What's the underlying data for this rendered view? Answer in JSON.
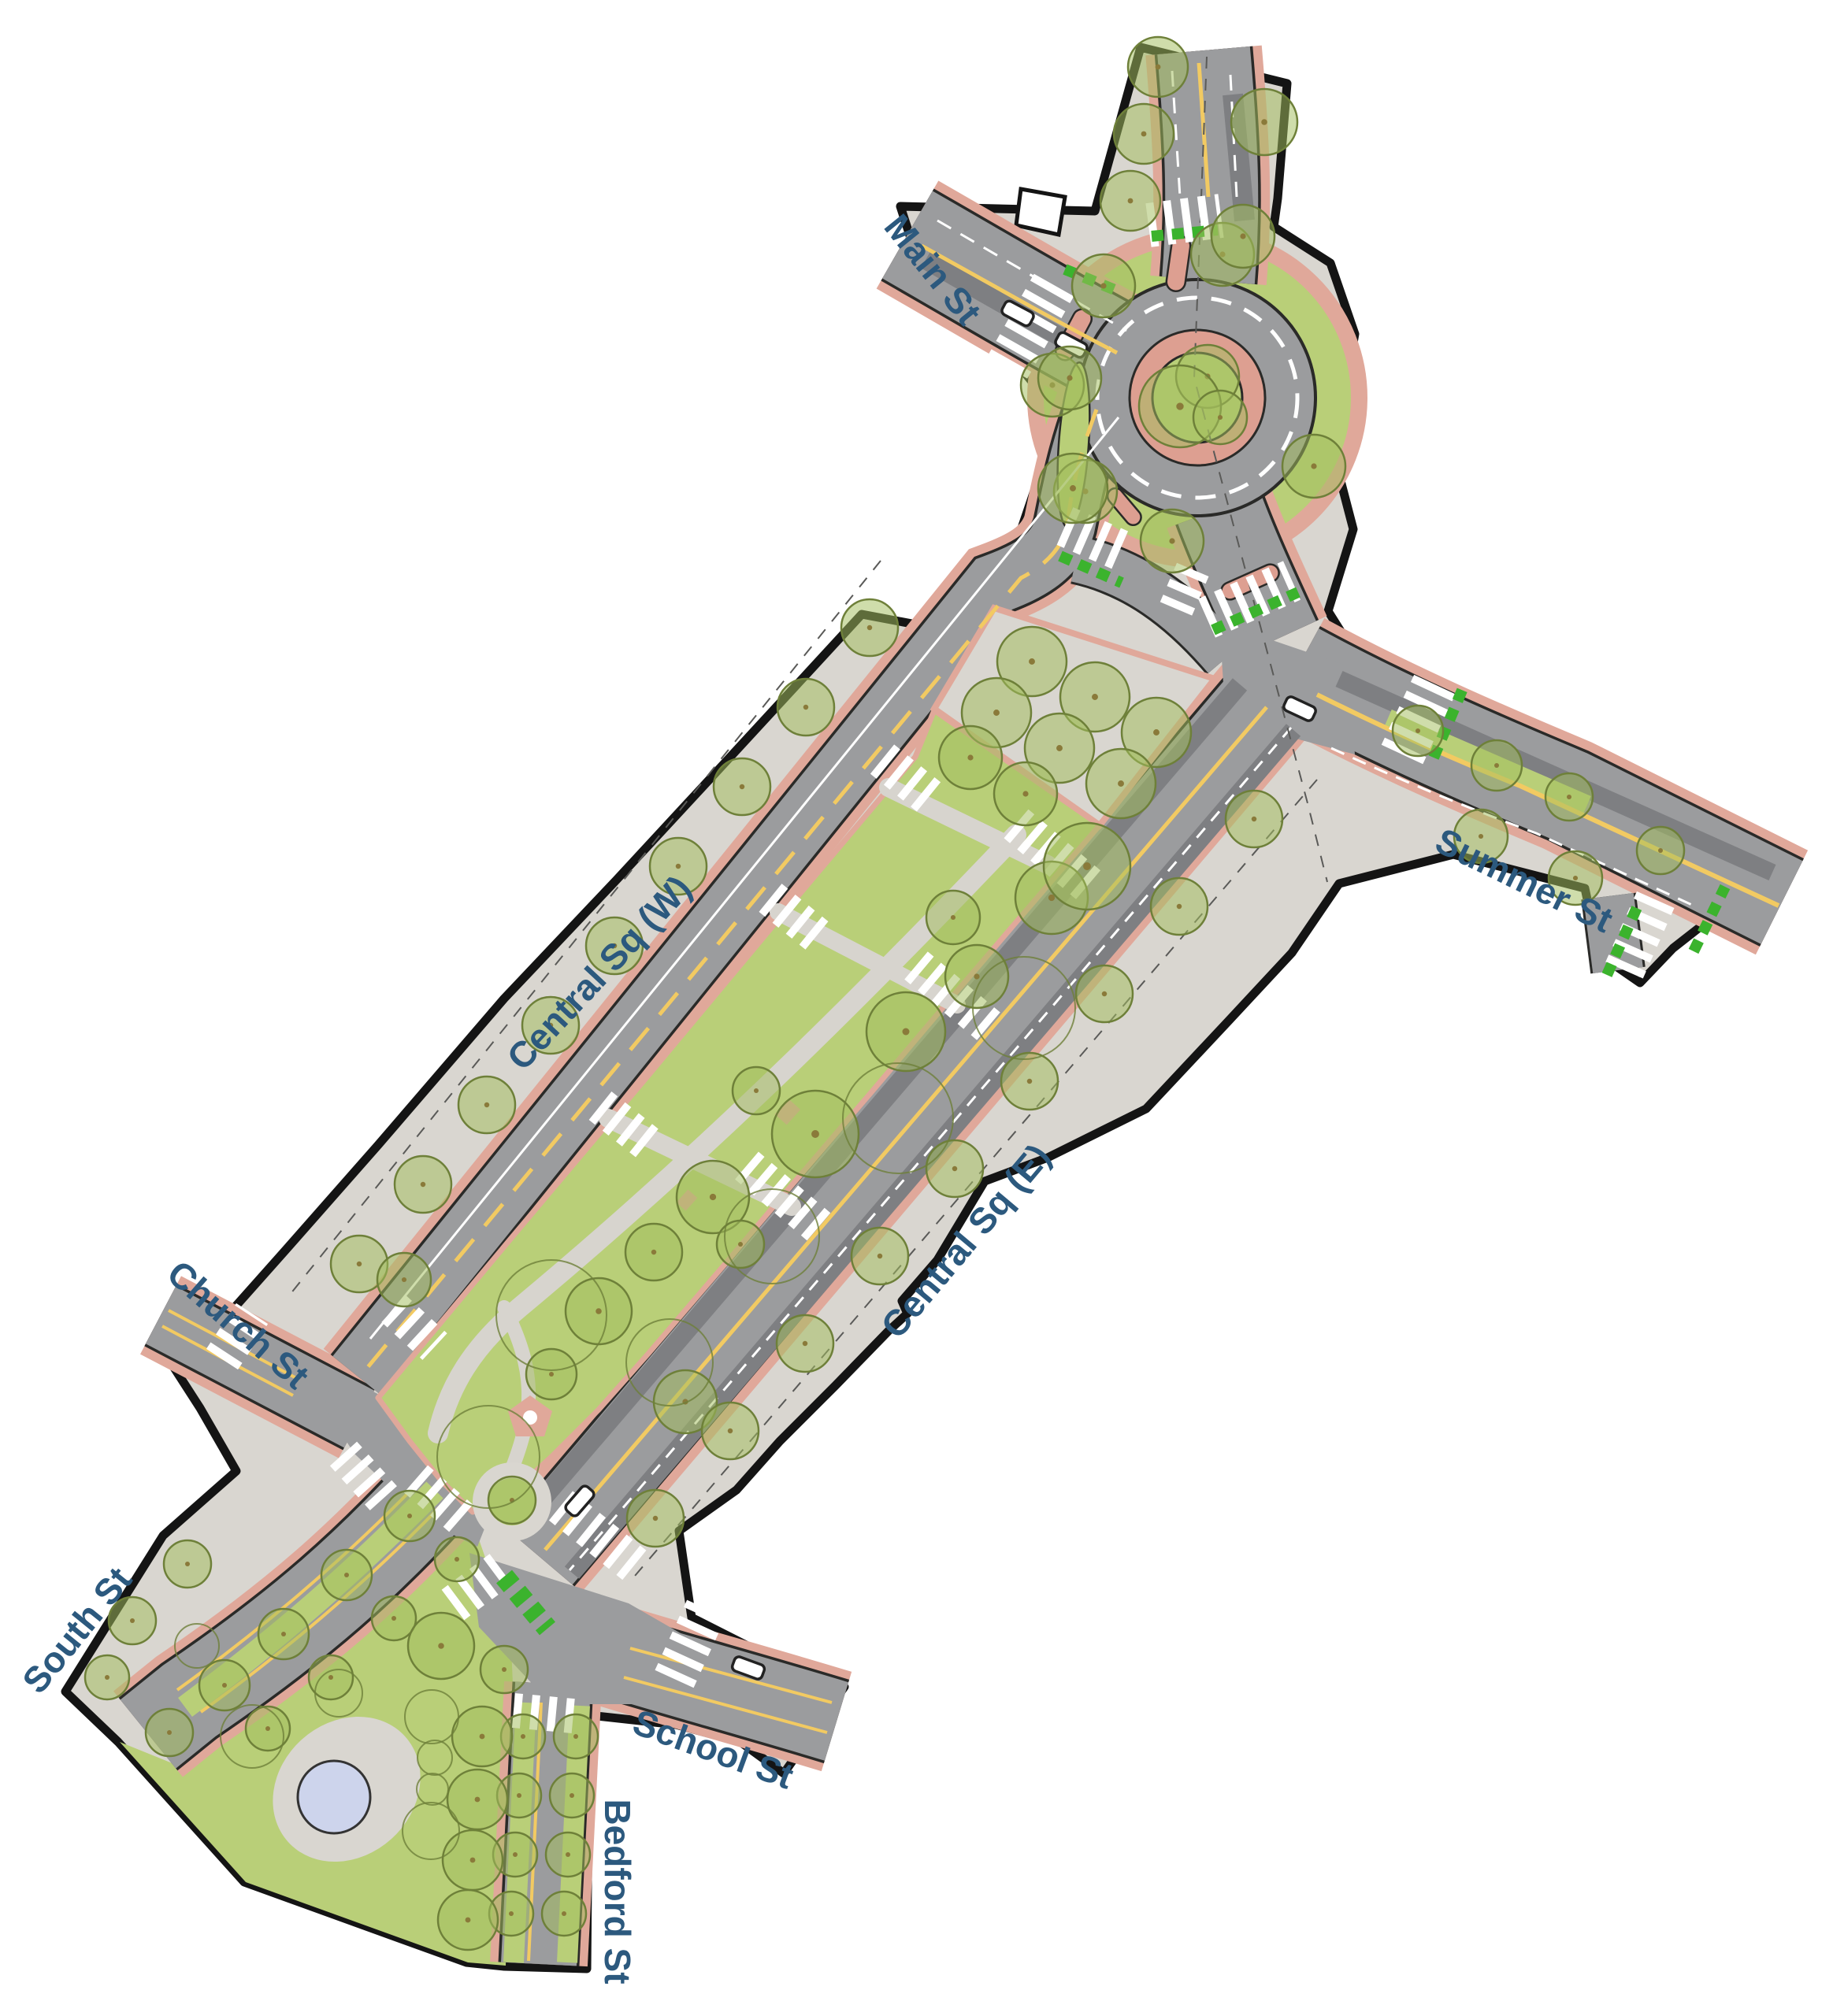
{
  "streets": [
    {
      "label": "Main St"
    },
    {
      "label": "Summer St"
    },
    {
      "label": "Central Sq (W)"
    },
    {
      "label": "Central Sq (E)"
    },
    {
      "label": "Church St"
    },
    {
      "label": "South St"
    },
    {
      "label": "School St"
    },
    {
      "label": "Bedford St"
    }
  ],
  "palette": {
    "background": "#ffffff",
    "sidewalk": "#d9d6d0",
    "road": "#9b9c9e",
    "road_dark": "#7e7f82",
    "outline": "#141414",
    "salmon_buffer": "#e0a89a",
    "truck_apron": "#dd9f91",
    "lawn_green": "#b9cf78",
    "tree_fill": "#a3bd5e",
    "tree_stroke": "#6e8039",
    "bike_green": "#3bb32d",
    "lane_yellow": "#f2ca62",
    "pond_blue": "#cdd4ec",
    "label_blue": "#2c597e"
  },
  "map": {
    "trees": [
      [
        1310,
        840,
        44
      ],
      [
        1390,
        885,
        44
      ],
      [
        1468,
        930,
        44
      ],
      [
        1265,
        905,
        44
      ],
      [
        1345,
        950,
        44
      ],
      [
        1423,
        995,
        44
      ],
      [
        1232,
        962,
        40
      ],
      [
        1302,
        1008,
        40
      ],
      [
        1335,
        1140,
        46
      ],
      [
        1380,
        1100,
        55
      ],
      [
        1240,
        1240,
        40
      ],
      [
        1150,
        1310,
        50
      ],
      [
        1035,
        1440,
        55
      ],
      [
        960,
        1385,
        30
      ],
      [
        905,
        1520,
        46
      ],
      [
        830,
        1590,
        36
      ],
      [
        760,
        1665,
        42
      ],
      [
        700,
        1745,
        32
      ],
      [
        940,
        1580,
        30
      ],
      [
        1210,
        1165,
        34
      ],
      [
        870,
        1780,
        40
      ],
      [
        650,
        1905,
        30
      ],
      [
        1104,
        797,
        36
      ],
      [
        1023,
        898,
        36
      ],
      [
        942,
        999,
        36
      ],
      [
        861,
        1100,
        36
      ],
      [
        780,
        1201,
        36
      ],
      [
        699,
        1302,
        36
      ],
      [
        618,
        1403,
        36
      ],
      [
        537,
        1504,
        36
      ],
      [
        456,
        1605,
        36
      ],
      [
        1592,
        1040,
        36
      ],
      [
        1497,
        1151,
        36
      ],
      [
        1402,
        1262,
        36
      ],
      [
        1307,
        1373,
        36
      ],
      [
        1212,
        1484,
        36
      ],
      [
        1117,
        1595,
        36
      ],
      [
        1022,
        1706,
        36
      ],
      [
        927,
        1817,
        36
      ],
      [
        832,
        1928,
        36
      ],
      [
        1533,
        478,
        40
      ],
      [
        1498,
        516,
        52
      ],
      [
        1549,
        530,
        34
      ],
      [
        1488,
        687,
        40
      ],
      [
        1378,
        624,
        40
      ],
      [
        1336,
        489,
        40
      ],
      [
        1401,
        363,
        40
      ],
      [
        1552,
        323,
        40
      ],
      [
        1668,
        592,
        40
      ],
      [
        1358,
        480,
        40
      ],
      [
        1362,
        620,
        44
      ],
      [
        1470,
        85,
        38
      ],
      [
        1452,
        170,
        38
      ],
      [
        1435,
        255,
        38
      ],
      [
        1605,
        155,
        42
      ],
      [
        1578,
        300,
        40
      ],
      [
        1800,
        928,
        32
      ],
      [
        1900,
        972,
        32
      ],
      [
        1992,
        1012,
        30
      ],
      [
        1880,
        1062,
        34
      ],
      [
        2000,
        1115,
        34
      ],
      [
        2108,
        1080,
        30
      ],
      [
        520,
        1925,
        32
      ],
      [
        440,
        2000,
        32
      ],
      [
        360,
        2075,
        32
      ],
      [
        285,
        2140,
        32
      ],
      [
        215,
        2200,
        30
      ],
      [
        580,
        1980,
        28
      ],
      [
        500,
        2055,
        28
      ],
      [
        420,
        2130,
        28
      ],
      [
        340,
        2195,
        28
      ],
      [
        238,
        1986,
        30
      ],
      [
        168,
        2058,
        30
      ],
      [
        136,
        2130,
        28
      ],
      [
        664,
        2205,
        28
      ],
      [
        659,
        2280,
        28
      ],
      [
        654,
        2355,
        28
      ],
      [
        649,
        2430,
        28
      ],
      [
        731,
        2205,
        28
      ],
      [
        726,
        2280,
        28
      ],
      [
        721,
        2355,
        28
      ],
      [
        716,
        2430,
        28
      ],
      [
        612,
        2205,
        38
      ],
      [
        606,
        2285,
        38
      ],
      [
        600,
        2362,
        38
      ],
      [
        594,
        2438,
        38
      ],
      [
        560,
        2090,
        42
      ],
      [
        640,
        2120,
        30
      ],
      [
        513,
        1625,
        34
      ]
    ],
    "trees_outline": [
      [
        700,
        1670,
        70
      ],
      [
        850,
        1730,
        55
      ],
      [
        620,
        1850,
        65
      ],
      [
        980,
        1570,
        60
      ],
      [
        1140,
        1420,
        70
      ],
      [
        1300,
        1280,
        65
      ],
      [
        548,
        2180,
        34
      ],
      [
        552,
        2232,
        22
      ],
      [
        549,
        2272,
        20
      ],
      [
        547,
        2325,
        36
      ],
      [
        320,
        2205,
        40
      ],
      [
        430,
        2150,
        30
      ],
      [
        250,
        2090,
        28
      ]
    ],
    "crosswalks": [
      [
        1458,
        286,
        1550,
        274,
        56
      ],
      [
        1338,
        362,
        1278,
        468,
        58
      ],
      [
        1352,
        668,
        1430,
        702,
        52
      ],
      [
        1493,
        773,
        1517,
        717,
        44
      ],
      [
        1532,
        785,
        1640,
        737,
        54
      ],
      [
        1780,
        958,
        1822,
        868,
        58
      ],
      [
        2062,
        1232,
        2102,
        1142,
        52
      ],
      [
        1120,
        964,
        1184,
        1016,
        48
      ],
      [
        1290,
        1046,
        1382,
        1124,
        48
      ],
      [
        978,
        1140,
        1042,
        1192,
        46
      ],
      [
        1163,
        1226,
        1256,
        1304,
        46
      ],
      [
        762,
        1404,
        827,
        1456,
        46
      ],
      [
        948,
        1480,
        1042,
        1560,
        46
      ],
      [
        282,
        1726,
        320,
        1668,
        48
      ],
      [
        500,
        1662,
        552,
        1710,
        46
      ],
      [
        436,
        1846,
        490,
        1906,
        46
      ],
      [
        528,
        1878,
        590,
        1932,
        46
      ],
      [
        712,
        1912,
        806,
        1988,
        48
      ],
      [
        856,
        2132,
        898,
        2040,
        54
      ],
      [
        652,
        2172,
        738,
        2180,
        44
      ],
      [
        575,
        2038,
        642,
        1988,
        48
      ]
    ],
    "bike_crossings": [
      [
        1462,
        300,
        1546,
        292,
        14
      ],
      [
        1352,
        342,
        1420,
        370,
        14
      ],
      [
        1346,
        706,
        1424,
        740,
        14
      ],
      [
        1540,
        800,
        1648,
        752,
        14
      ],
      [
        1820,
        962,
        1858,
        872,
        14
      ],
      [
        2040,
        1238,
        2080,
        1148,
        14
      ],
      [
        2150,
        1208,
        2190,
        1126,
        14
      ],
      [
        640,
        2002,
        695,
        2068,
        26
      ]
    ],
    "cars": [
      [
        1292,
        398,
        28
      ],
      [
        1360,
        438,
        28
      ],
      [
        1650,
        900,
        25
      ],
      [
        736,
        1906,
        -49
      ],
      [
        950,
        2118,
        20
      ]
    ]
  }
}
